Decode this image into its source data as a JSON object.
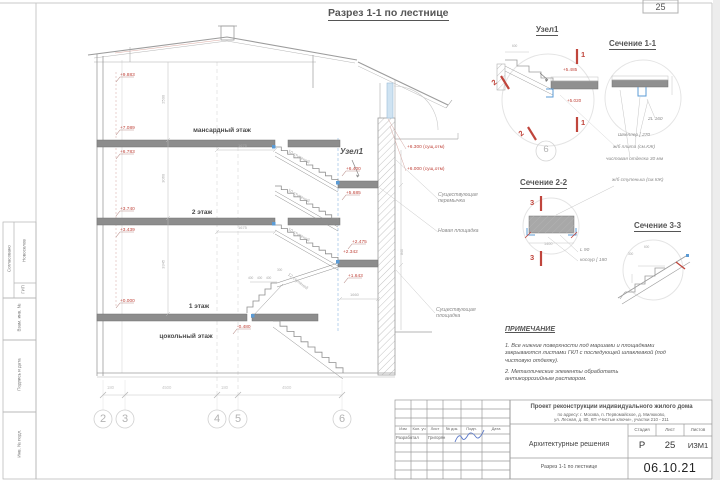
{
  "frame": {
    "page_number": "25"
  },
  "title": "Разрез 1-1 по лестнице",
  "stamp": {
    "agreed": "Согласовано",
    "name": "Новоселов",
    "role": "ГИП",
    "vzam": "Взам. инв. №",
    "sign": "Подпись и дата",
    "inv": "Инв. № подл."
  },
  "floors": [
    "мансардный этаж",
    "2 этаж",
    "1 этаж",
    "цокольный этаж"
  ],
  "levels": {
    "left": [
      "+9.883",
      "+7.089",
      "+6.783",
      "+3.740",
      "+3.439",
      "+0.000"
    ],
    "basement": "-0.480",
    "stair": [
      "+6.400",
      "+5.685",
      "+2.475",
      "+2.342",
      "+1.643"
    ],
    "existing": [
      "+6.300 (сущ.отм)",
      "+6.000 (сущ.отм)"
    ]
  },
  "node_callout": "Узел1",
  "stair_labels": {
    "ten": "10 ступеней",
    "twelve": "12 ступеней"
  },
  "dims": {
    "horiz": [
      "1675",
      "1675",
      "1660"
    ],
    "vert": [
      "2500",
      "3060",
      "3345"
    ],
    "treads": [
      "400",
      "400",
      "400",
      "300"
    ],
    "right": "840",
    "axes": [
      "180",
      "4500",
      "180",
      "4500"
    ]
  },
  "annotations": [
    "Существующая\nперемычка",
    "Новая площадка",
    "Существующая\nплощадка"
  ],
  "axes": [
    "2",
    "3",
    "4",
    "5",
    "6"
  ],
  "details": {
    "node": {
      "title": "Узел1",
      "cut1": "1",
      "cut2": "2",
      "levels": [
        "+5.485",
        "+5.020"
      ],
      "dim": "600",
      "axis": "6"
    },
    "s11": {
      "title": "Сечение 1-1",
      "a1": "2L 160",
      "a2": "Швеллер [ 270",
      "a3": "ж/б плита (см.КЖ)",
      "a4": "чистовая отделка 30 мм"
    },
    "s22": {
      "title": "Сечение 2-2",
      "cut": "3",
      "a1": "ж/б ступенька (см.КЖ)",
      "dim": "1400",
      "a2": "L 90",
      "a3": "косоур [ 180"
    },
    "s33": {
      "title": "Сечение 3-3",
      "d1": "600",
      "d2": "300"
    }
  },
  "notes": {
    "title": "ПРИМЕЧАНИЕ",
    "items": [
      "1.    Все нижние поверхности под маршами и площадками закрываются листами ГКЛ с последующей шпаклевкой (под чистовую отделку).",
      "2.    Металлические элементы обработать антикоррозийным раствором."
    ]
  },
  "titleblock": {
    "project": [
      "Проект реконструкции индивидуального жилого дома",
      "по адресу: г. Москва, п. Первомайское, д. Милюково,",
      "ул. Лесная, д. 80, КП «Чистые ключи», участки 210 - 211"
    ],
    "cols": [
      "Изм",
      "Кол. уч",
      "Лист",
      "№ док.",
      "Подп.",
      "Дата"
    ],
    "dev_label": "Разработал",
    "dev_name": "Григорян",
    "section": "Архитектурные решения",
    "stage_h": "Стадия",
    "sheet_h": "Лист",
    "sheets_h": "Листов",
    "stage": "Р",
    "sheet": "25",
    "sheets": "ИЗМ1",
    "subtitle": "Разрез 1-1 по лестнице",
    "date": "06.10.21"
  }
}
